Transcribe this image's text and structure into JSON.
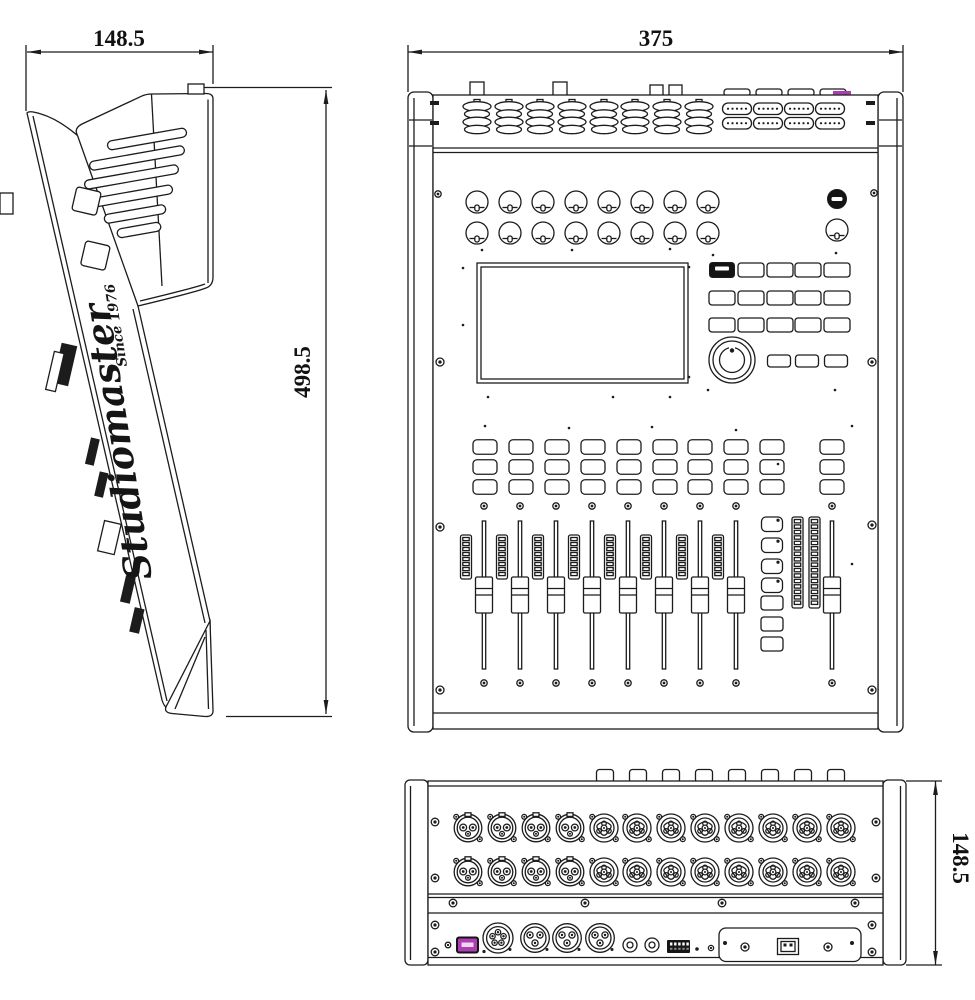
{
  "dimensions": {
    "side_width": "148.5",
    "side_depth": "498.5",
    "top_width": "375",
    "rear_height": "148.5"
  },
  "logo": {
    "brand": "Studiomaster",
    "tagline": "Since 1976"
  },
  "colors": {
    "ink": "#1c1c1c",
    "background": "#ffffff",
    "usb_port": "#ae3cb2",
    "usb_slot": "#eed5f0"
  },
  "top_panel": {
    "knob_rows": 2,
    "knobs_per_row": 8,
    "soft_button_rows": 3,
    "soft_buttons_per_row": 5,
    "channel_button_stacks": 9,
    "buttons_per_stack": 3,
    "channel_faders": 8,
    "master_faders": 1,
    "layer_buttons": 4,
    "dark_buttons": 3,
    "channel_meter_segments": 8,
    "main_meters": 2,
    "main_meter_segments": 16
  },
  "rear_panel": {
    "connector_rows": 2,
    "round_xlr_columns": 4,
    "combo_input_columns": 8,
    "aux_xlr_5pin": 1,
    "aux_xlr_3pin": 3,
    "phone_jacks": 2,
    "usb_a_ports": 1,
    "usb_b_ports": 1,
    "top_tabs": 8
  }
}
